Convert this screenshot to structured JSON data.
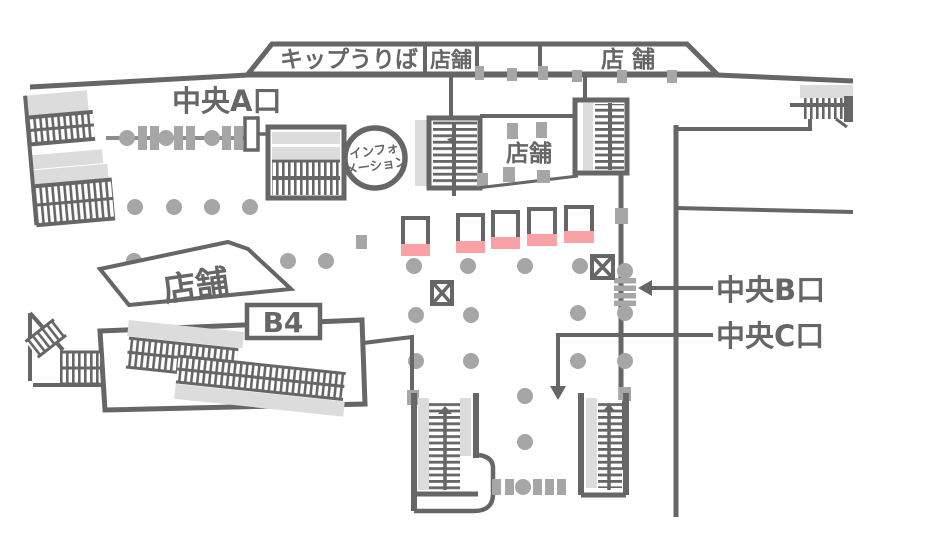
{
  "title": "station-concourse-floor-map",
  "colors": {
    "wall_dark": "#666666",
    "pillar_gray": "#a6a6a6",
    "escalator_band": "#dcdcdc",
    "kiosk_pink": "#f9a1a5",
    "background": "#ffffff"
  },
  "banner": {
    "ticket_office": "キップうりば",
    "shop": "店舗",
    "shop_spaced": "店 舗"
  },
  "labels": {
    "exit_a": "中央A口",
    "exit_b": "中央B口",
    "exit_c": "中央C口",
    "info_line1": "インフォ",
    "info_line2": "メーション",
    "shop_center": "店舗",
    "shop_left": "店舗",
    "level_badge": "B4"
  }
}
